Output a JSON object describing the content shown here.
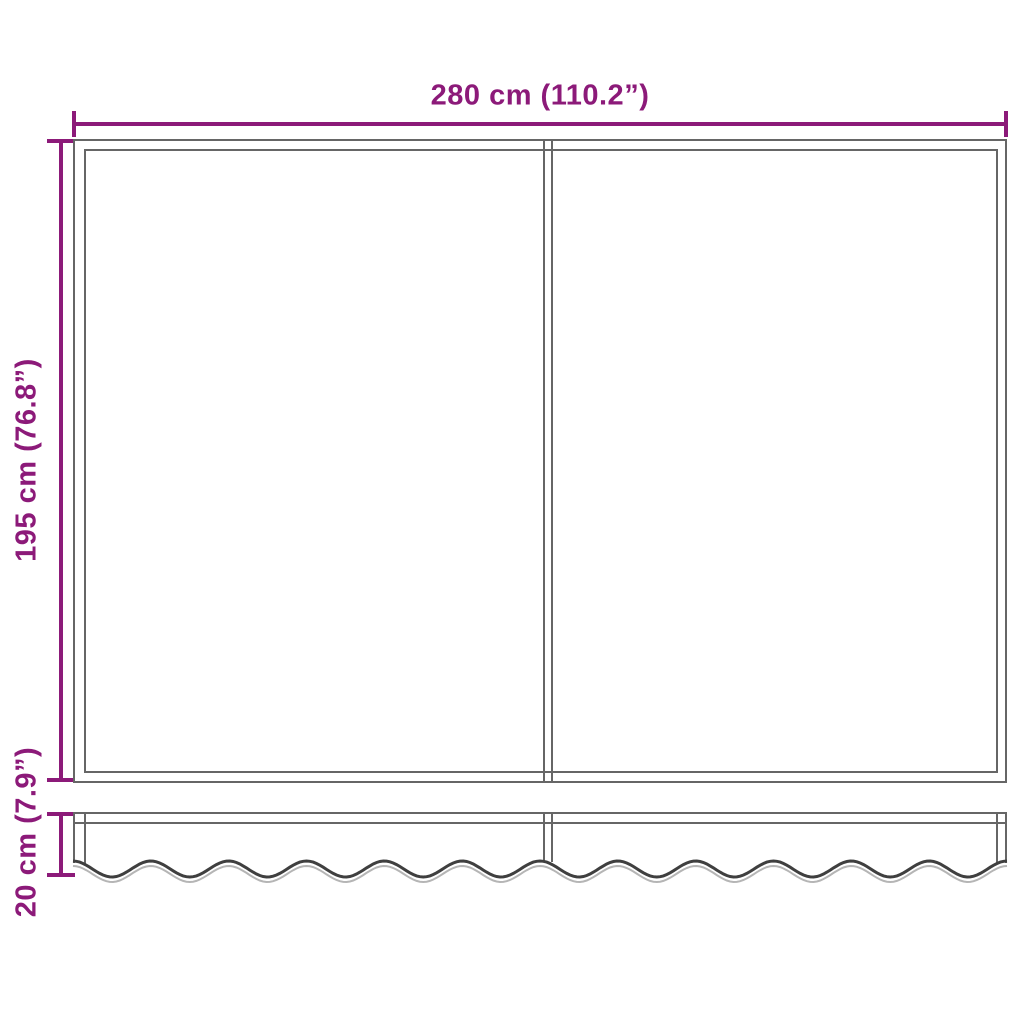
{
  "labels": {
    "width": "280 cm (110.2”)",
    "height": "195 cm (76.8”)",
    "valance": "20 cm (7.9”)"
  },
  "colors": {
    "accent": "#8C1A79",
    "line": "#666666",
    "line_dark": "#3F3F3F",
    "line_light": "#B5B5B5",
    "bg": "#FFFFFF"
  }
}
